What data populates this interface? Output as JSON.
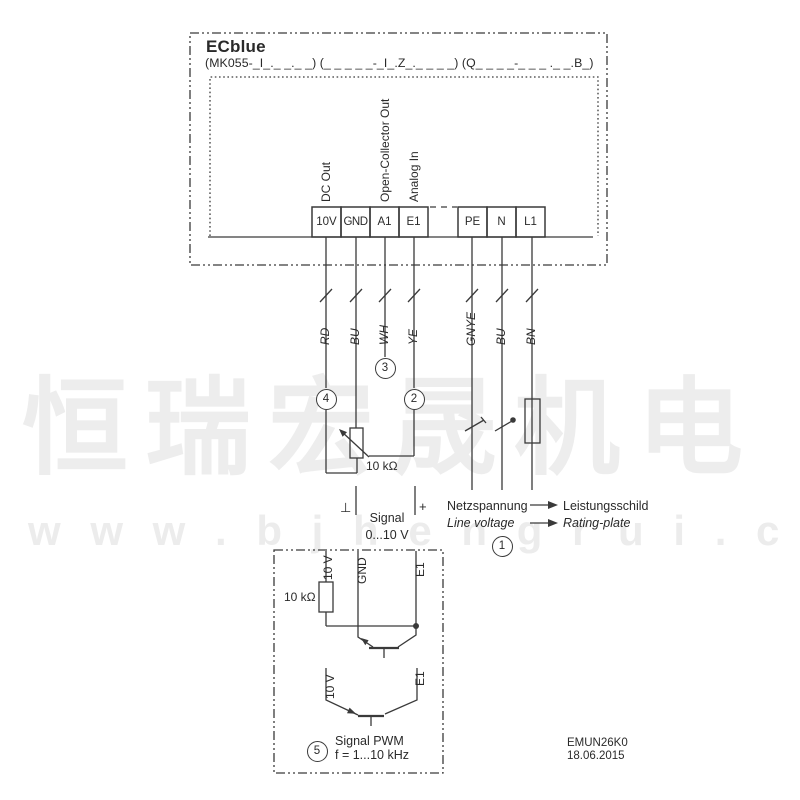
{
  "device": {
    "title": "ECblue",
    "model_line": "(MK055-_I_._ _._ _) (_ _ _ _ _-_I_.Z_._ _ _ _) (Q_ _ _ _-_ _ _ ._ _.B_)"
  },
  "terminals": {
    "signal_group": [
      {
        "id": "10V",
        "function": "DC Out"
      },
      {
        "id": "GND",
        "function": ""
      },
      {
        "id": "A1",
        "function": "Open-Collector Out"
      },
      {
        "id": "E1",
        "function": "Analog In"
      }
    ],
    "mains_group": [
      {
        "id": "PE"
      },
      {
        "id": "N"
      },
      {
        "id": "L1"
      }
    ]
  },
  "wires": {
    "signal": [
      "RD",
      "BU",
      "WH",
      "YE"
    ],
    "mains": [
      "GNYE",
      "BU",
      "BN"
    ]
  },
  "callouts": {
    "c1": "1",
    "c2": "2",
    "c3": "3",
    "c4": "4",
    "c5": "5"
  },
  "annotations": {
    "pot_value": "10 kΩ",
    "signal_minus": "⊥",
    "signal_plus": "+",
    "signal_label": "Signal",
    "signal_range": "0...10 V",
    "mains_de": "Netzspannung",
    "mains_en": "Line voltage",
    "plate_de": "Leistungsschild",
    "plate_en": "Rating-plate"
  },
  "pwm_box": {
    "resistor_value": "10 kΩ",
    "rail_label_1": "10 V",
    "gnd_label": "GND",
    "input_label_1": "E1",
    "rail_label_2": "10 V",
    "input_label_2": "E1",
    "title": "Signal PWM",
    "frequency": "f = 1...10 kHz"
  },
  "footer": {
    "doc_number": "EMUN26K0",
    "date": "18.06.2015"
  },
  "watermark": {
    "cn": "恒瑞宏晟机电",
    "url": "w w w . b j h e n g r u i . c n"
  },
  "colors": {
    "line": "#3a3a3a",
    "text": "#2a2a2a",
    "watermark": "#ededed"
  }
}
